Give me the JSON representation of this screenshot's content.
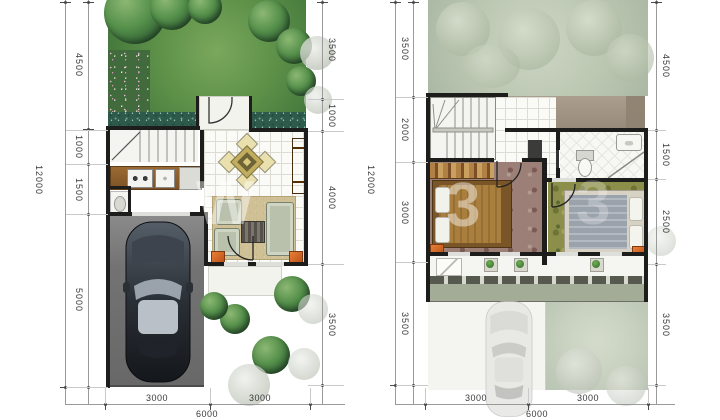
{
  "title": "two-storey-house-floor-plans",
  "watermark": {
    "glyphs": [
      "W",
      "3",
      "3"
    ]
  },
  "ground_floor": {
    "dim_total_height": "12000",
    "dims_left": [
      "4500",
      "1000",
      "1500",
      "5000"
    ],
    "dims_right": [
      "3500",
      "1000",
      "4000",
      "3500"
    ],
    "dims_bottom": [
      "3000",
      "3000"
    ],
    "dim_total_width": "6000"
  },
  "upper_floor": {
    "dim_total_height": "12000",
    "dims_left": [
      "3500",
      "2000",
      "3000",
      "3500"
    ],
    "dims_right": [
      "4500",
      "1500",
      "2500",
      "3500"
    ],
    "dims_bottom": [
      "3000",
      "3000"
    ],
    "dim_total_width": "6000"
  },
  "colors": {
    "wall": "#1d1d1b",
    "lawn_green": "#5d9048",
    "faded_lawn": "#bcc7b2",
    "accent_orange": "#d2691e",
    "garage_gray": "#737373",
    "dimension_text": "#3a3a3a"
  }
}
